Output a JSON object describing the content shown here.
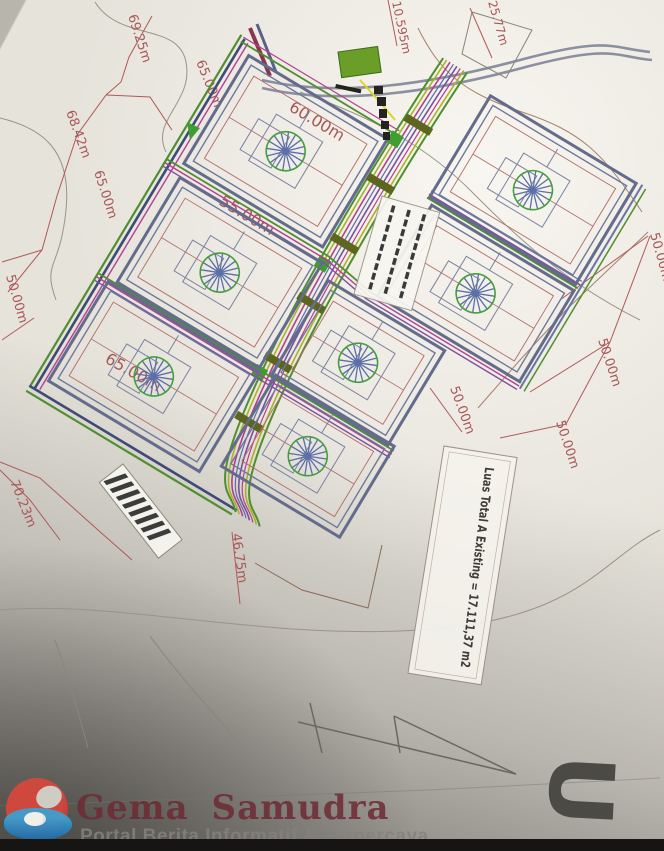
{
  "drawing": {
    "type": "site plan photo",
    "area_note": "Luas Total A Existing = 17.111,37 m2",
    "north_label": "U",
    "legend_box": {
      "legible": false
    },
    "hatched_label_box": {
      "legible": false
    },
    "gate_label": {
      "legible": false
    }
  },
  "dims": [
    {
      "label": "69.25m"
    },
    {
      "label": "65.00m"
    },
    {
      "label": "68.42m"
    },
    {
      "label": "65.00m"
    },
    {
      "label": "50.00m"
    },
    {
      "label": "10.595m"
    },
    {
      "label": "25.77m"
    },
    {
      "label": "60.00m"
    },
    {
      "label": "55.00m"
    },
    {
      "label": "65.00m"
    },
    {
      "label": "70.23m"
    },
    {
      "label": "46.75m"
    },
    {
      "label": "50.00m"
    },
    {
      "label": "50.00m"
    },
    {
      "label": "50.00m"
    },
    {
      "label": "50.00m"
    }
  ],
  "watermark": {
    "title": "Gema Samudra",
    "tagline": "Portal Berita Informatif & Terpercaya"
  },
  "colors": {
    "paper": "#e6e3db",
    "dim_red": "#a85757",
    "plot_border": "#646c8c",
    "road_magenta": "#b0409a",
    "road_purple": "#7050a0",
    "road_olive": "#a8b428",
    "road_green": "#4a9030",
    "tree_green": "#44a03c",
    "tree_blue": "#5b6fa8",
    "watermark_red": "#6e2a34"
  }
}
